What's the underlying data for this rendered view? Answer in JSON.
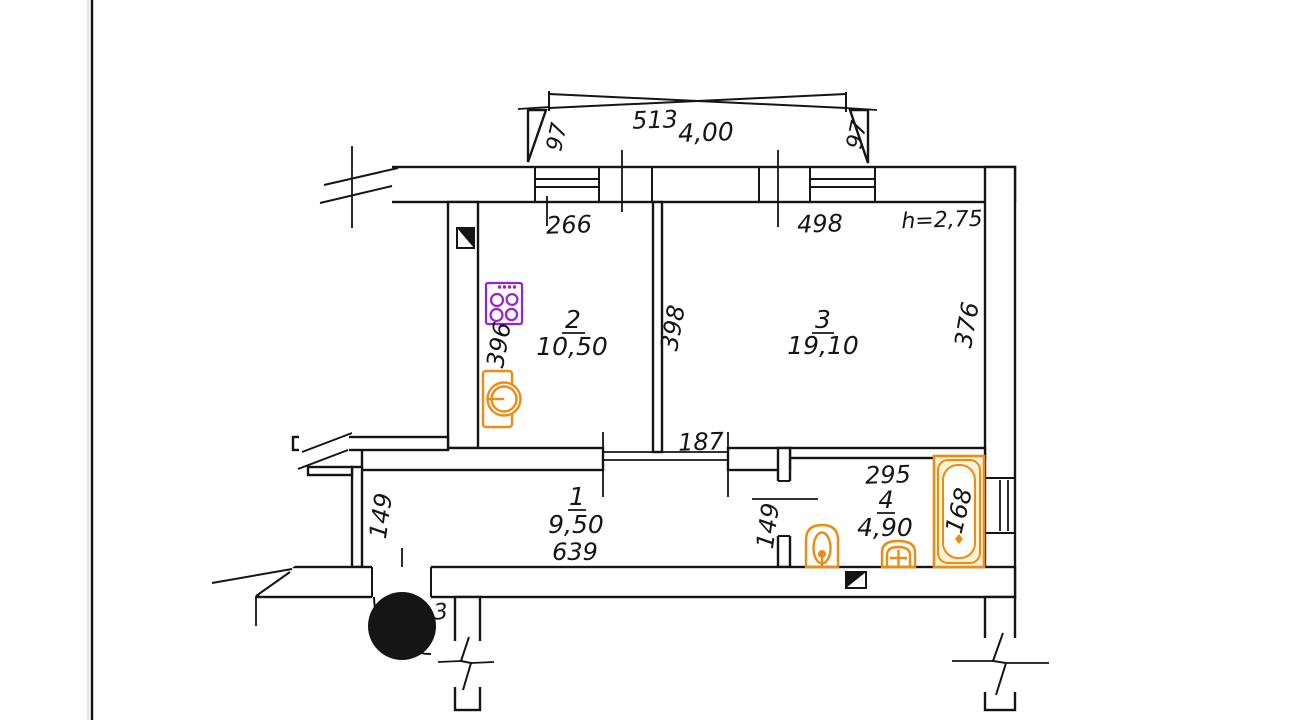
{
  "document": {
    "type": "apartment floor plan (as-built survey drawing)"
  },
  "colors": {
    "line": "#151515",
    "fixture-orange": "#ed8c12",
    "fixture-purple": "#9c20cc",
    "tub-fill": "#fbf2da",
    "paper": "#ffffff"
  },
  "labels": {
    "balcony_width": "513",
    "balcony_area": "4,00",
    "balcony_side_left": "97",
    "balcony_side_right": "97",
    "kitchen_width": "266",
    "room3_width": "498",
    "ceiling_height": "h=2,75",
    "kitchen_depth": "396",
    "divider_depth": "398",
    "room3_depth": "376",
    "kitchen_number": "2",
    "kitchen_area": "10,50",
    "room3_number": "3",
    "room3_area": "19,10",
    "hall_number": "1",
    "hall_area": "9,50",
    "hall_width": "639",
    "hall_depth": "149",
    "room3_door_width": "187",
    "bath_width": "295",
    "bath_number": "4",
    "bath_area": "4,90",
    "bath_door_width": "149",
    "bathtub_length": "168",
    "entrance_partial_digit": "3"
  },
  "icons": {
    "stove": "stove-icon",
    "kitchen_sink": "kitchen-sink-icon",
    "toilet": "toilet-icon",
    "wash_basin": "wash-basin-icon",
    "bathtub": "bathtub-icon",
    "vent_kitchen": "vent-duct-icon",
    "vent_bath": "vent-duct-icon",
    "redaction": "redaction-dot"
  }
}
